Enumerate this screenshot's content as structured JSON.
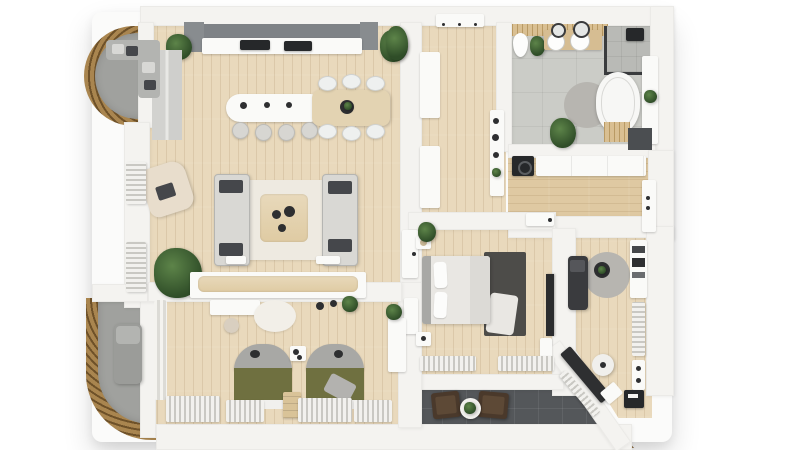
{
  "scene": {
    "title": "Apartment floor plan – photorealistic 3D top-down render",
    "view": "top-down",
    "style": "3D rendered floor plan, white walls, light oak floors"
  },
  "colors": {
    "background": "#ffffff",
    "wall": "#f4f3f0",
    "wall_edge": "#e3e2de",
    "wood_floor": "#e9d9bc",
    "wood_warm": "#dfc9a2",
    "plank_line": "rgba(146,114,70,0.16)",
    "bath_floor": "#cbccc7",
    "shower_floor": "#b9bab6",
    "balcony_floor": "#a0a19e",
    "terrace_floor": "#54575a",
    "slat_light": "#a9854f",
    "slat_dark": "#6e5129",
    "slat_light2": "#8a6b42",
    "slat_dark2": "#5e4526",
    "cabinet_dark": "#7e8286",
    "appliance": "#26282a",
    "counter_white": "#f5f5f3",
    "sofa": "#d9d8d4",
    "sofa_dark": "#b5b5b2",
    "pillow_dark": "#45474b",
    "rug_cream": "#eeeae1",
    "rug_dark": "#4d4c49",
    "rug_grey": "#b7b5b0",
    "table_wood": "#e3d3b2",
    "duvet_white": "#e9e7e3",
    "headboard_grey": "#a8a8a5",
    "olive": "#6f7040",
    "radiator_light": "#f2f1ee",
    "radiator_dark": "#c9c8c3",
    "plant_dark": "#2f4d28",
    "plant_light": "#5d8449",
    "chair_brown": "#4a392b",
    "chair_brown_light": "#5d4936",
    "white_furniture": "#fafaf8",
    "vanity_wood": "#d6bd92",
    "tv_dark": "#2b2c2e"
  },
  "rooms": [
    {
      "id": "living-kitchen",
      "label": "Open-plan kitchen and living room",
      "floor": "light oak planks",
      "furniture": [
        "dark upper kitchen cabinets",
        "white countertop with sink and cooktop",
        "kitchen island with 4 bar stools",
        "dining table with 6 white chairs",
        "two facing grey sofas with dark pillows",
        "wooden coffee table",
        "cream rug",
        "beige armchair",
        "sideboard bench with wood top",
        "large potted plant",
        "wall radiators",
        "tall cabinet panels"
      ]
    },
    {
      "id": "balcony-top-left",
      "label": "Curved balcony (upper)",
      "floor": "grey tile",
      "furniture": [
        "corner sofa with cushions",
        "curved timber slat railing"
      ]
    },
    {
      "id": "hall",
      "label": "Entrance hall",
      "floor": "light oak planks",
      "furniture": [
        "entrance door",
        "two wardrobe cabinets",
        "console shelf with decor and plant"
      ]
    },
    {
      "id": "bathroom",
      "label": "Bathroom",
      "floor": "grey stone tile",
      "furniture": [
        "toilet",
        "double vanity with two round basins",
        "round mirrors",
        "walk-in shower with glass screen",
        "freestanding oval bathtub",
        "round grey rug",
        "timber bath mat",
        "dark bath mat",
        "potted plants",
        "wall ledge"
      ]
    },
    {
      "id": "closet-corridor",
      "label": "Walk-in closet / utility corridor",
      "floor": "oak planks",
      "furniture": [
        "long wardrobe cabinet",
        "washing machine",
        "white door"
      ]
    },
    {
      "id": "master-bedroom",
      "label": "Bedroom",
      "floor": "light oak planks",
      "furniture": [
        "double bed with white duvet",
        "dark grey rug with white throw",
        "two nightstands",
        "table lamp",
        "wall TV panel",
        "media unit",
        "two radiators",
        "potted plant"
      ]
    },
    {
      "id": "kids-bedroom",
      "label": "Kids bedroom",
      "floor": "light oak planks",
      "furniture": [
        "two single beds with olive duvets",
        "arched grey headboards",
        "shared nightstand",
        "step stool",
        "desk with stool",
        "round cream rug",
        "tall wardrobe",
        "potted plant",
        "radiators under windows",
        "curtains"
      ]
    },
    {
      "id": "office",
      "label": "Study / office",
      "floor": "light oak planks",
      "furniture": [
        "dark daybed",
        "round grey rug",
        "round side table",
        "bookshelf",
        "angled desk",
        "white office chair",
        "drawer unit",
        "file box",
        "radiators"
      ]
    },
    {
      "id": "terrace",
      "label": "Terrace",
      "floor": "dark grey tile",
      "furniture": [
        "two brown lounge chairs",
        "round white coffee table",
        "potted plant",
        "timber deck edge"
      ]
    },
    {
      "id": "balcony-bottom-left",
      "label": "Curved balcony (lower)",
      "floor": "grey tile",
      "furniture": [
        "grey lounge chair",
        "curved timber slat railing"
      ]
    }
  ]
}
